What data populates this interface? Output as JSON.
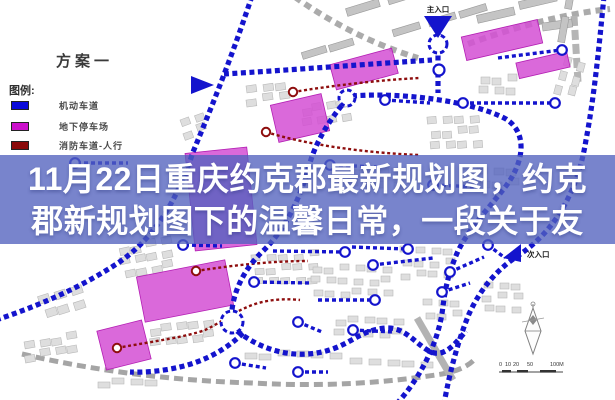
{
  "overlay": {
    "line1": "11月22日重庆约克郡最新规划图，约克",
    "line2": "郡新规划图下的温馨日常，一段关于友"
  },
  "plan": {
    "title": "方案一"
  },
  "legend": {
    "heading": "图例:",
    "items": [
      {
        "label": "机动车道",
        "color": "#0a0ada"
      },
      {
        "label": "地下停车场",
        "color": "#cc10cc"
      },
      {
        "label": "消防车道-人行",
        "color": "#8a0a0a"
      }
    ]
  },
  "map_labels": {
    "main_entrance": "主入口",
    "secondary_entrance": "次入口"
  },
  "scale_bar": {
    "ticks": [
      "0",
      "10",
      "20",
      "50"
    ],
    "end_label": "100M"
  },
  "icons": {
    "main_entrance_marker": "triangle-down-icon",
    "secondary_entrance_marker": "triangle-left-icon",
    "west_entrance_marker": "triangle-right-icon",
    "compass": "north-compass-icon"
  },
  "colors": {
    "road_blue": "#1414cd",
    "parking_magenta": "#d44fd4",
    "fire_lane_red": "#8e0e0e",
    "building_gray": "#dedede",
    "overlay_band": "rgba(82,98,190,0.78)",
    "overlay_text": "#ffffff"
  }
}
